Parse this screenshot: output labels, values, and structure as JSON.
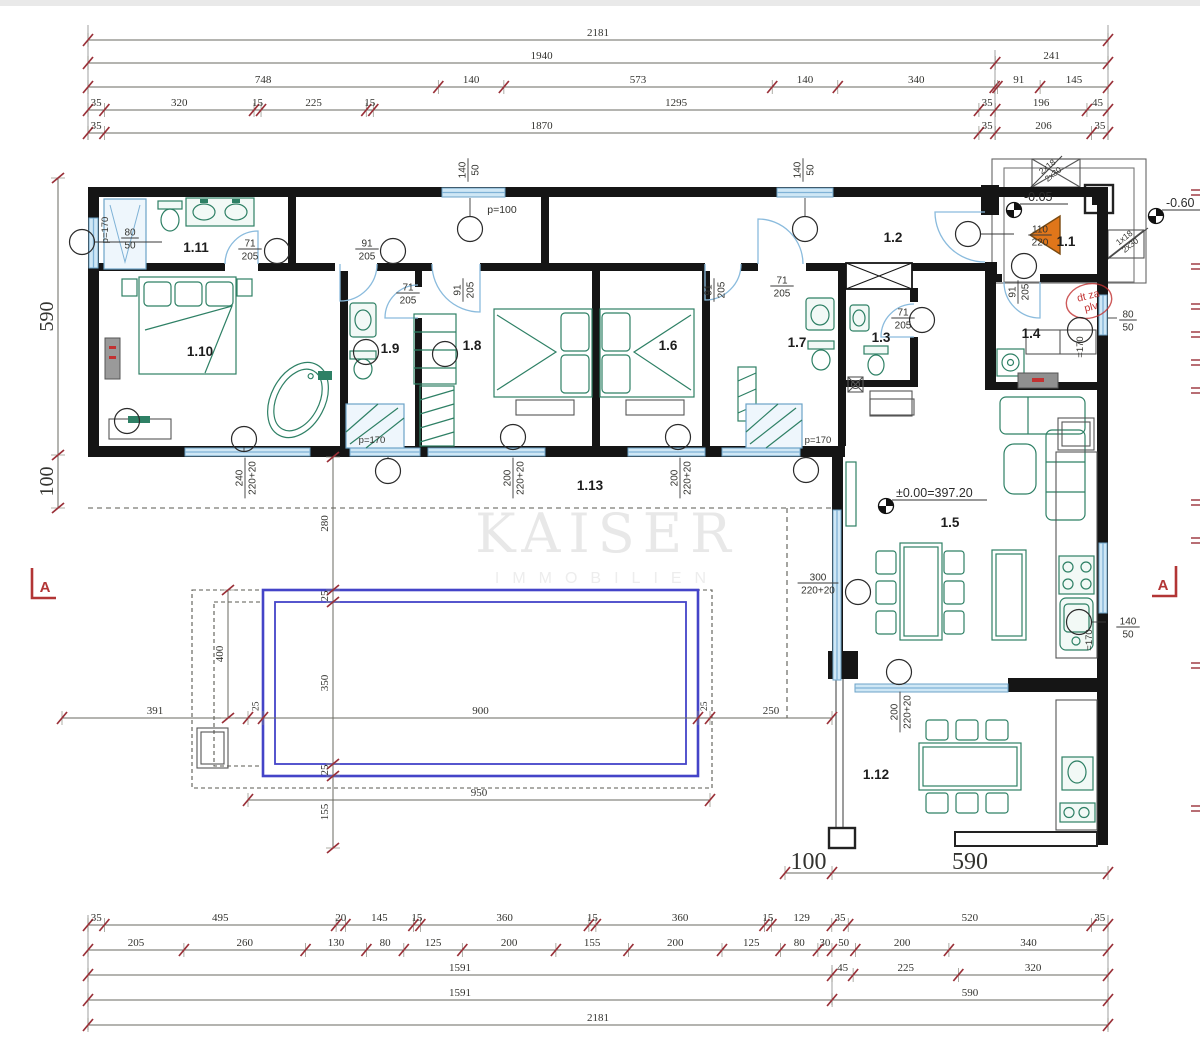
{
  "watermark": {
    "line1": "KAISER",
    "line2": "IMMOBILIEN"
  },
  "colors": {
    "tick": "#9a3038",
    "dim": "#33332f",
    "wall": "#151515",
    "green": "#2e8065",
    "blue": "#6ca3c8",
    "pool": "#4444c8",
    "red": "#c23232",
    "orange": "#e0761a"
  },
  "rooms": [
    {
      "id": "1.1",
      "x": 1066,
      "y": 246
    },
    {
      "id": "1.2",
      "x": 893,
      "y": 242
    },
    {
      "id": "1.3",
      "x": 881,
      "y": 342
    },
    {
      "id": "1.4",
      "x": 1031,
      "y": 338
    },
    {
      "id": "1.5",
      "x": 950,
      "y": 527
    },
    {
      "id": "1.6",
      "x": 668,
      "y": 350
    },
    {
      "id": "1.7",
      "x": 797,
      "y": 347
    },
    {
      "id": "1.8",
      "x": 472,
      "y": 350
    },
    {
      "id": "1.9",
      "x": 390,
      "y": 353
    },
    {
      "id": "1.10",
      "x": 200,
      "y": 356
    },
    {
      "id": "1.11",
      "x": 196,
      "y": 252
    },
    {
      "id": "1.12",
      "x": 876,
      "y": 779
    },
    {
      "id": "1.13",
      "x": 590,
      "y": 490
    }
  ],
  "levels": [
    {
      "label": "-0.05",
      "sx": 1014,
      "sy": 210,
      "ll": 48
    },
    {
      "label": "-0.60",
      "sx": 1156,
      "sy": 216,
      "ll": 42
    },
    {
      "label": "±0.00=397.20",
      "sx": 886,
      "sy": 506,
      "ll": 95
    }
  ],
  "sections": [
    {
      "label": "A",
      "x": 32,
      "y": 568,
      "flip": false
    },
    {
      "label": "A",
      "x": 1176,
      "y": 566,
      "flip": true
    }
  ],
  "chains": [
    {
      "dir": "h",
      "y": 40,
      "from": 88,
      "to": 1108,
      "segs": [
        {
          "v": 2181,
          "t": "2181"
        }
      ]
    },
    {
      "dir": "h",
      "y": 63,
      "from": 88,
      "to": 1108,
      "segs": [
        {
          "v": 1940,
          "t": "1940"
        },
        {
          "v": 241,
          "t": "241"
        }
      ]
    },
    {
      "dir": "h",
      "y": 87,
      "from": 88,
      "to": 1108,
      "segs": [
        {
          "v": 748,
          "t": "748"
        },
        {
          "v": 140,
          "t": "140"
        },
        {
          "v": 573,
          "t": "573"
        },
        {
          "v": 140,
          "t": "140"
        },
        {
          "v": 335,
          "t": "340"
        },
        {
          "v": 6,
          "t": ""
        },
        {
          "v": 91,
          "t": "91"
        },
        {
          "v": 145,
          "t": "145"
        }
      ]
    },
    {
      "dir": "h",
      "y": 110,
      "from": 88,
      "to": 1108,
      "segs": [
        {
          "v": 35,
          "t": "35"
        },
        {
          "v": 320,
          "t": "320"
        },
        {
          "v": 15,
          "t": "15"
        },
        {
          "v": 225,
          "t": "225"
        },
        {
          "v": 15,
          "t": "15"
        },
        {
          "v": 1295,
          "t": "1295"
        },
        {
          "v": 35,
          "t": "35"
        },
        {
          "v": 196,
          "t": "196"
        },
        {
          "v": 45,
          "t": "45"
        }
      ]
    },
    {
      "dir": "h",
      "y": 133,
      "from": 88,
      "to": 1108,
      "segs": [
        {
          "v": 35,
          "t": "35"
        },
        {
          "v": 1870,
          "t": "1870"
        },
        {
          "v": 35,
          "t": "35"
        },
        {
          "v": 206,
          "t": "206"
        },
        {
          "v": 35,
          "t": "35"
        }
      ]
    },
    {
      "dir": "h",
      "y": 925,
      "from": 88,
      "to": 1108,
      "segs": [
        {
          "v": 35,
          "t": "35"
        },
        {
          "v": 495,
          "t": "495"
        },
        {
          "v": 20,
          "t": "20"
        },
        {
          "v": 145,
          "t": "145"
        },
        {
          "v": 15,
          "t": "15"
        },
        {
          "v": 360,
          "t": "360"
        },
        {
          "v": 15,
          "t": "15"
        },
        {
          "v": 360,
          "t": "360"
        },
        {
          "v": 15,
          "t": "15"
        },
        {
          "v": 129,
          "t": "129"
        },
        {
          "v": 35,
          "t": "35"
        },
        {
          "v": 520,
          "t": "520"
        },
        {
          "v": 35,
          "t": "35"
        }
      ]
    },
    {
      "dir": "h",
      "y": 950,
      "from": 88,
      "to": 1108,
      "segs": [
        {
          "v": 205,
          "t": "205"
        },
        {
          "v": 260,
          "t": "260"
        },
        {
          "v": 130,
          "t": "130"
        },
        {
          "v": 80,
          "t": "80"
        },
        {
          "v": 125,
          "t": "125"
        },
        {
          "v": 200,
          "t": "200"
        },
        {
          "v": 155,
          "t": "155"
        },
        {
          "v": 200,
          "t": "200"
        },
        {
          "v": 125,
          "t": "125"
        },
        {
          "v": 80,
          "t": "80"
        },
        {
          "v": 30,
          "t": "30"
        },
        {
          "v": 50,
          "t": "50"
        },
        {
          "v": 200,
          "t": "200"
        },
        {
          "v": 340,
          "t": "340"
        }
      ]
    },
    {
      "dir": "h",
      "y": 975,
      "from": 88,
      "to": 1108,
      "segs": [
        {
          "v": 1591,
          "t": "1591"
        },
        {
          "v": 45,
          "t": "45"
        },
        {
          "v": 225,
          "t": "225"
        },
        {
          "v": 320,
          "t": "320"
        }
      ]
    },
    {
      "dir": "h",
      "y": 1000,
      "from": 88,
      "to": 1108,
      "segs": [
        {
          "v": 1591,
          "t": "1591"
        },
        {
          "v": 590,
          "t": "590"
        }
      ]
    },
    {
      "dir": "h",
      "y": 1025,
      "from": 88,
      "to": 1108,
      "segs": [
        {
          "v": 2181,
          "t": "2181"
        }
      ]
    },
    {
      "dir": "v",
      "x": 58,
      "from": 178,
      "to": 508,
      "s": 20,
      "segs": [
        {
          "v": 277,
          "t": "590"
        },
        {
          "v": 53,
          "t": "100"
        }
      ]
    },
    {
      "dir": "h",
      "y": 718,
      "from": 62,
      "to": 832,
      "rs": 1,
      "segs": [
        {
          "v": 186,
          "t": "391"
        },
        {
          "v": 15,
          "t": "25"
        },
        {
          "v": 435,
          "t": "900"
        },
        {
          "v": 12,
          "t": "25"
        },
        {
          "v": 122,
          "t": "250"
        }
      ]
    },
    {
      "dir": "h",
      "y": 800,
      "from": 248,
      "to": 710,
      "segs": [
        {
          "v": 462,
          "t": "950"
        }
      ]
    },
    {
      "dir": "v",
      "x": 333,
      "from": 457,
      "to": 848,
      "segs": [
        {
          "v": 133,
          "t": "280"
        },
        {
          "v": 12,
          "t": "25"
        },
        {
          "v": 162,
          "t": "350"
        },
        {
          "v": 12,
          "t": "25"
        },
        {
          "v": 72,
          "t": "155"
        }
      ]
    },
    {
      "dir": "v",
      "x": 228,
      "from": 590,
      "to": 718,
      "segs": [
        {
          "v": 128,
          "t": "400"
        }
      ]
    },
    {
      "dir": "h",
      "y": 873,
      "from": 785,
      "to": 1108,
      "s": 24,
      "segs": [
        {
          "v": 47,
          "t": "100"
        },
        {
          "v": 276,
          "t": "590"
        }
      ]
    }
  ],
  "fractions": [
    {
      "t": "80",
      "b": "50",
      "x": 130,
      "y": 238,
      "r": 0
    },
    {
      "t": "71",
      "b": "205",
      "x": 250,
      "y": 249,
      "r": 0
    },
    {
      "t": "91",
      "b": "205",
      "x": 367,
      "y": 249,
      "r": 0
    },
    {
      "t": "71",
      "b": "205",
      "x": 408,
      "y": 293,
      "r": 0
    },
    {
      "t": "91",
      "b": "205",
      "x": 463,
      "y": 290,
      "r": -90
    },
    {
      "t": "91",
      "b": "205",
      "x": 714,
      "y": 290,
      "r": -90
    },
    {
      "t": "71",
      "b": "205",
      "x": 782,
      "y": 286,
      "r": 0
    },
    {
      "t": "71",
      "b": "205",
      "x": 903,
      "y": 318,
      "r": 0
    },
    {
      "t": "91",
      "b": "205",
      "x": 1018,
      "y": 292,
      "r": -90
    },
    {
      "t": "110",
      "b": "220",
      "x": 1040,
      "y": 235,
      "r": 0
    },
    {
      "t": "140",
      "b": "50",
      "x": 468,
      "y": 170,
      "r": -90
    },
    {
      "t": "140",
      "b": "50",
      "x": 803,
      "y": 170,
      "r": -90
    },
    {
      "t": "80",
      "b": "50",
      "x": 1128,
      "y": 320,
      "r": 0
    },
    {
      "t": "140",
      "b": "50",
      "x": 1128,
      "y": 627,
      "r": 0
    },
    {
      "t": "240",
      "b": "220+20",
      "x": 245,
      "y": 478,
      "r": -90
    },
    {
      "t": "200",
      "b": "220+20",
      "x": 513,
      "y": 478,
      "r": -90
    },
    {
      "t": "200",
      "b": "220+20",
      "x": 680,
      "y": 478,
      "r": -90
    },
    {
      "t": "200",
      "b": "220+20",
      "x": 900,
      "y": 712,
      "r": -90
    },
    {
      "t": "300",
      "b": "220+20",
      "x": 818,
      "y": 583,
      "r": 0
    }
  ],
  "notes": [
    {
      "t": "p=100",
      "x": 502,
      "y": 213,
      "s": 10.5
    },
    {
      "t": "p=170",
      "x": 372,
      "y": 443,
      "s": 9.5
    },
    {
      "t": "p=170",
      "x": 818,
      "y": 443,
      "s": 9.5
    },
    {
      "t": "p=170",
      "x": 108,
      "y": 230,
      "s": 9.5,
      "r": -90
    },
    {
      "t": "=170",
      "x": 1083,
      "y": 347,
      "s": 9.5,
      "r": -90
    },
    {
      "t": "=170",
      "x": 1092,
      "y": 640,
      "s": 9.5,
      "r": -90
    },
    {
      "t": "2x18",
      "t2": "2x30",
      "x": 1049,
      "y": 169,
      "s": 8.5,
      "r": -38
    },
    {
      "t": "1x18",
      "t2": "2x30",
      "x": 1126,
      "y": 240,
      "s": 8.5,
      "r": -38
    },
    {
      "t": "dt za",
      "t2": "plv",
      "x": 1089,
      "y": 299,
      "s": 10.5,
      "r": -14,
      "c": "#c23232"
    }
  ],
  "circles": [
    [
      82,
      242
    ],
    [
      470,
      229
    ],
    [
      805,
      229
    ],
    [
      277,
      251
    ],
    [
      393,
      251
    ],
    [
      366,
      352
    ],
    [
      445,
      354
    ],
    [
      968,
      234
    ],
    [
      1024,
      266
    ],
    [
      922,
      320
    ],
    [
      1080,
      330
    ],
    [
      127,
      421
    ],
    [
      244,
      439
    ],
    [
      388,
      471
    ],
    [
      513,
      437
    ],
    [
      678,
      437
    ],
    [
      806,
      470
    ],
    [
      858,
      592
    ],
    [
      899,
      672
    ],
    [
      1079,
      622
    ]
  ],
  "edge_ticks": [
    190,
    264,
    304,
    332,
    360,
    388,
    500,
    538,
    663,
    806
  ]
}
